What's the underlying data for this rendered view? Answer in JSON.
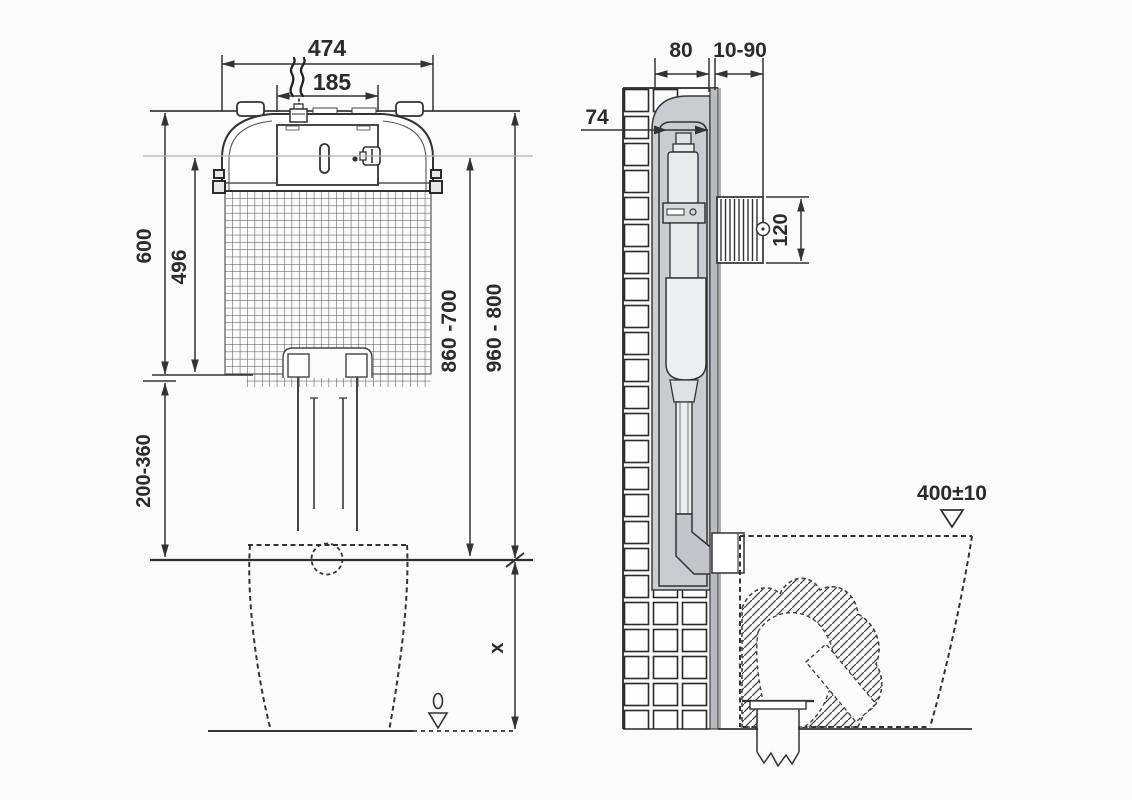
{
  "meta": {
    "type": "technical installation drawing",
    "subject": "concealed toilet cistern with wall installation, front and side section views"
  },
  "front_view": {
    "width_total": "474",
    "width_flush_plate": "185",
    "height_tank_zone": "600",
    "height_tank_body": "496",
    "height_pipe_adjust": "200-360",
    "height_inner": "860 -700",
    "height_outer": "960 - 800",
    "floor_offset": "x"
  },
  "side_view": {
    "niche_depth": "80",
    "wall_finish_thickness": "10-90",
    "cistern_depth": "74",
    "access_box_height": "120",
    "bowl_rim_height": "400±10"
  },
  "colors": {
    "line": "#333333",
    "dim_text": "#2b2b2b",
    "grey_fill": "#c9ccd0",
    "board_fill": "#b9bdc1",
    "light_fill": "#eceeef",
    "faint_line": "#b0b0b0",
    "background": "#fbfbfb"
  }
}
